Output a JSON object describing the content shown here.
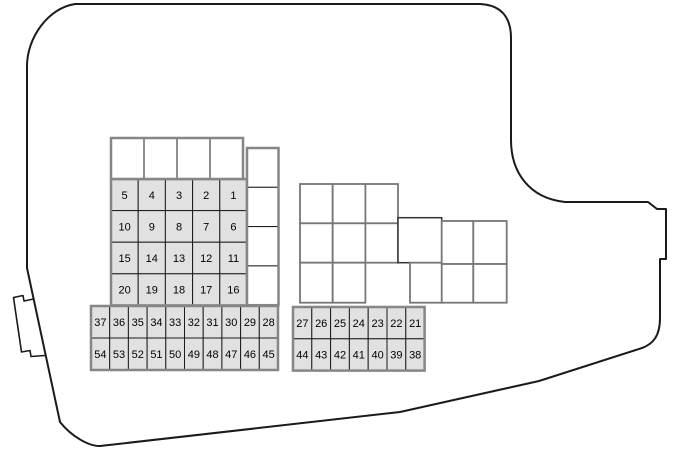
{
  "page": {
    "background": "#ffffff"
  },
  "diagram": {
    "name": "engine-compartment-fuse-box-top-view",
    "font_px": 11,
    "colors": {
      "background": "#ffffff",
      "outline": "#1a1a1a",
      "fuse_fill": "#e1e1e1",
      "relay_fill": "#ffffff",
      "grid_border": "#868686",
      "inner_line": "#1c1c1c",
      "relay_border": "#777777",
      "relay_border_dark": "#333333",
      "label": "#000000"
    },
    "grids": [
      {
        "name": "main-fuse-grid",
        "x": 111,
        "y": 179,
        "cols": 5,
        "rows": 4,
        "cellW": 27.2,
        "cellH": 31.6,
        "style": "fuse",
        "values": [
          [
            "5",
            "4",
            "3",
            "2",
            "1"
          ],
          [
            "10",
            "9",
            "8",
            "7",
            "6"
          ],
          [
            "15",
            "14",
            "13",
            "12",
            "11"
          ],
          [
            "20",
            "19",
            "18",
            "17",
            "16"
          ]
        ]
      },
      {
        "name": "left-mini-fuse-grid",
        "x": 91,
        "y": 306,
        "cols": 10,
        "rows": 2,
        "cellW": 18.7,
        "cellH": 32,
        "style": "fuse",
        "values": [
          [
            "37",
            "36",
            "35",
            "34",
            "33",
            "32",
            "31",
            "30",
            "29",
            "28"
          ],
          [
            "54",
            "53",
            "52",
            "51",
            "50",
            "49",
            "48",
            "47",
            "46",
            "45"
          ]
        ]
      },
      {
        "name": "right-mini-fuse-grid",
        "x": 293,
        "y": 307,
        "cols": 7,
        "rows": 2,
        "cellW": 18.8,
        "cellH": 31.8,
        "style": "fuse",
        "values": [
          [
            "27",
            "26",
            "25",
            "24",
            "23",
            "22",
            "21"
          ],
          [
            "44",
            "43",
            "42",
            "41",
            "40",
            "39",
            "38"
          ]
        ]
      },
      {
        "name": "top-connector-row",
        "x": 111,
        "y": 138,
        "cols": 4,
        "rows": 1,
        "cellW": 33,
        "cellH": 41,
        "style": "blank",
        "values": null
      },
      {
        "name": "right-connector-column",
        "x": 247,
        "y": 148,
        "cols": 1,
        "rows": 4,
        "cellW": 31.5,
        "cellH": 39.3,
        "style": "blank",
        "values": null
      }
    ],
    "relay_cells": [
      {
        "x": 300,
        "y": 184,
        "w": 32.7,
        "h": 39.3
      },
      {
        "x": 332.7,
        "y": 184,
        "w": 32.7,
        "h": 39.3
      },
      {
        "x": 365.4,
        "y": 184,
        "w": 32.6,
        "h": 39.3
      },
      {
        "x": 300,
        "y": 223.3,
        "w": 32.7,
        "h": 39.4
      },
      {
        "x": 332.7,
        "y": 223.3,
        "w": 32.7,
        "h": 39.4
      },
      {
        "x": 365.4,
        "y": 223.3,
        "w": 32.6,
        "h": 39.4
      },
      {
        "x": 300,
        "y": 262.7,
        "w": 32.7,
        "h": 40
      },
      {
        "x": 332.7,
        "y": 262.7,
        "w": 32.7,
        "h": 40
      },
      {
        "x": 398,
        "y": 217.7,
        "w": 43.7,
        "h": 45,
        "dark": true
      },
      {
        "x": 410,
        "y": 262.7,
        "w": 32.7,
        "h": 40
      },
      {
        "x": 441.7,
        "y": 221,
        "w": 31.6,
        "h": 43
      },
      {
        "x": 473.3,
        "y": 221,
        "w": 33.4,
        "h": 43
      },
      {
        "x": 441.7,
        "y": 264,
        "w": 31.6,
        "h": 38.7
      },
      {
        "x": 473.3,
        "y": 264,
        "w": 33.4,
        "h": 38.7
      }
    ]
  }
}
